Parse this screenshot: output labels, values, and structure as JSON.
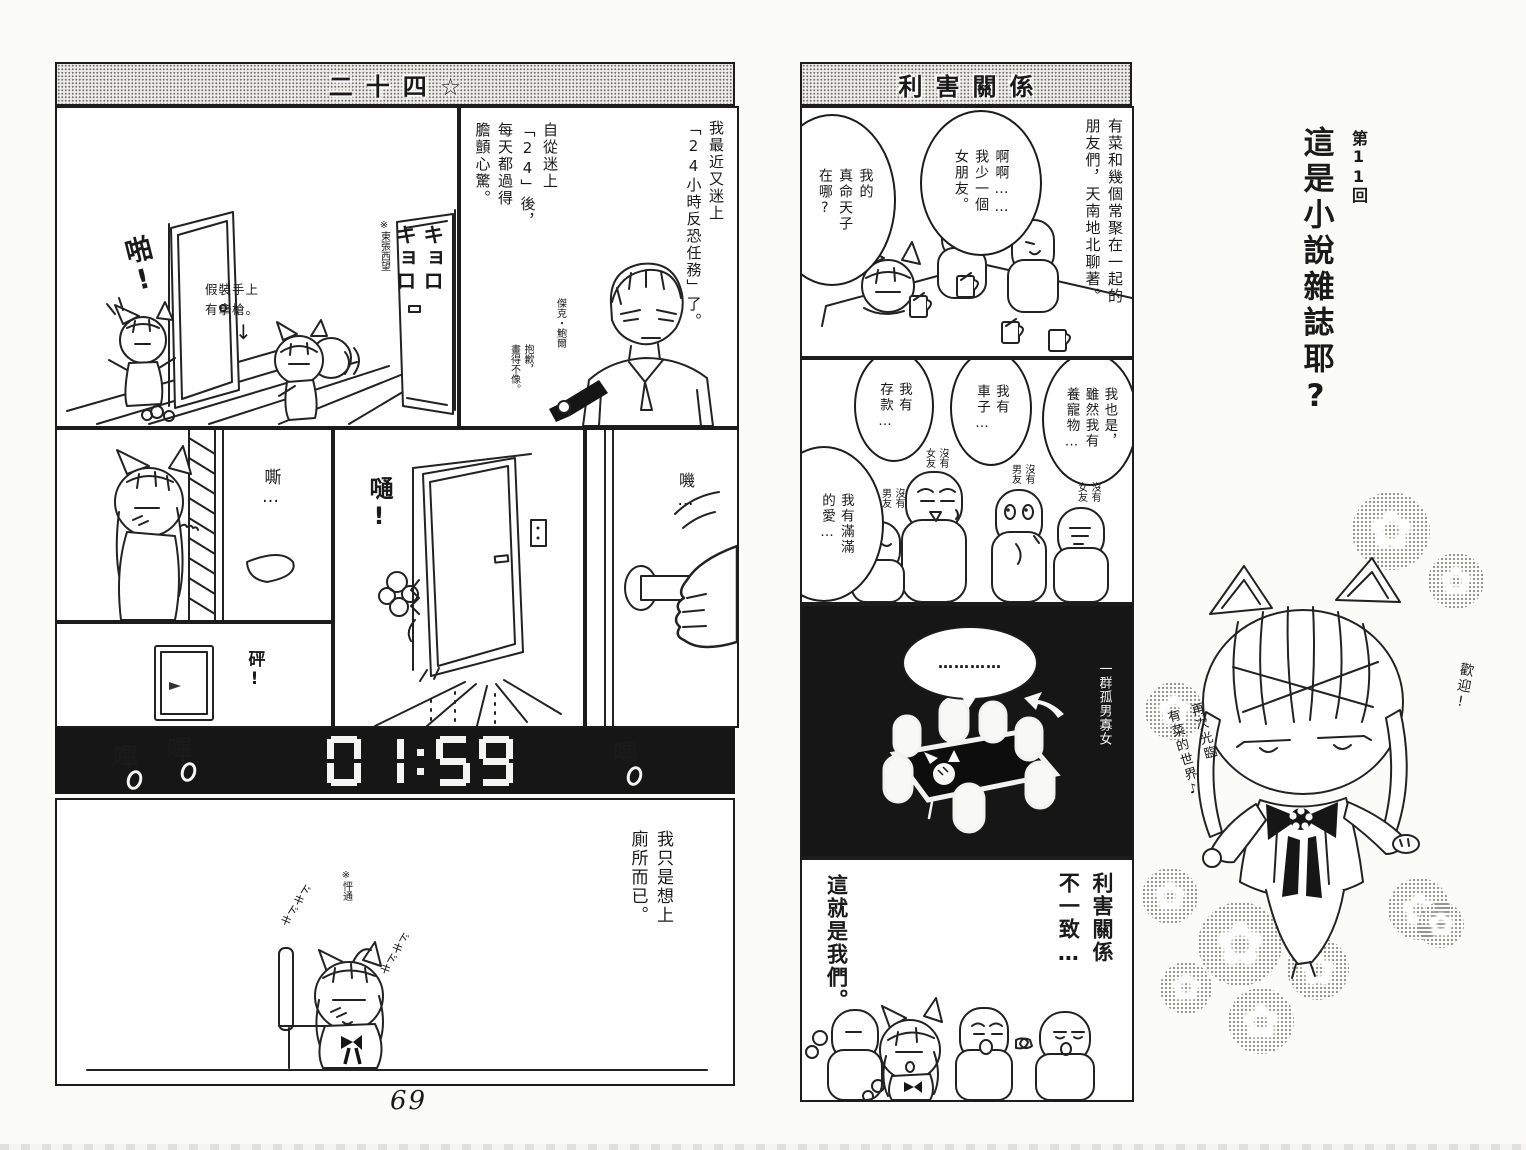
{
  "page": {
    "number": "69"
  },
  "icons": {
    "down_arrow": "↓",
    "flower": "✿"
  },
  "left_page": {
    "title": "二十四☆",
    "p1": {
      "sfx_pa": "啪!",
      "note_gun": "假裝手上\n有拿槍。",
      "note_look": "※東張西望",
      "sfx_kyoro": "キョロ\nキョロ"
    },
    "p2": {
      "n1": "我最近又迷上\n「24小時反恐任務」了。",
      "n2": "自從迷上\n「24」後，\n每天都過得\n膽顫心驚。",
      "jack": "傑克・鮑爾",
      "sorry": "抱歉，\n畫得不像。"
    },
    "p3": {
      "sfx": "嘶…"
    },
    "p4": {
      "sfx": "砰!"
    },
    "p5": {
      "sfx": "嗵!"
    },
    "p6": {
      "sfx": "嘰…"
    },
    "clock": {
      "time": "01:59",
      "beep1": "嗶",
      "beep2": "嗶",
      "beep3": "嗶"
    },
    "p7": {
      "n": "我只是想上\n廁所而已。",
      "note": "※怦通",
      "doki1": "ドキドキ",
      "doki2": "ドキドキ"
    }
  },
  "right_page": {
    "title": "利害關係",
    "p1": {
      "n": "有菜和幾個常聚在一起的\n朋友們，天南地北聊著。",
      "b1": "啊啊……\n我少一個\n女朋友。",
      "b2": "我的\n真命天子\n在哪?"
    },
    "p2": {
      "b1": "我也是，\n雖然我有\n養寵物…",
      "b2": "我有\n車子…",
      "b3": "我有\n存款…",
      "b4": "我有滿滿\n的愛…",
      "tag_center": "沒有\n女友",
      "tag_left": "沒有\n男友",
      "tag_mid": "沒有\n男友",
      "tag_right": "沒有\n女友"
    },
    "p3": {
      "bubble": "…………",
      "label": "一群孤男寡女"
    },
    "p4": {
      "t1": "利害關係\n不一致…",
      "t2": "這就是我們。"
    }
  },
  "sidebar": {
    "chapter": "第11回",
    "title": "這是小說雜誌耶?",
    "hello": "歡迎!",
    "welcome": "再次光臨\n有菜的世界♪"
  }
}
